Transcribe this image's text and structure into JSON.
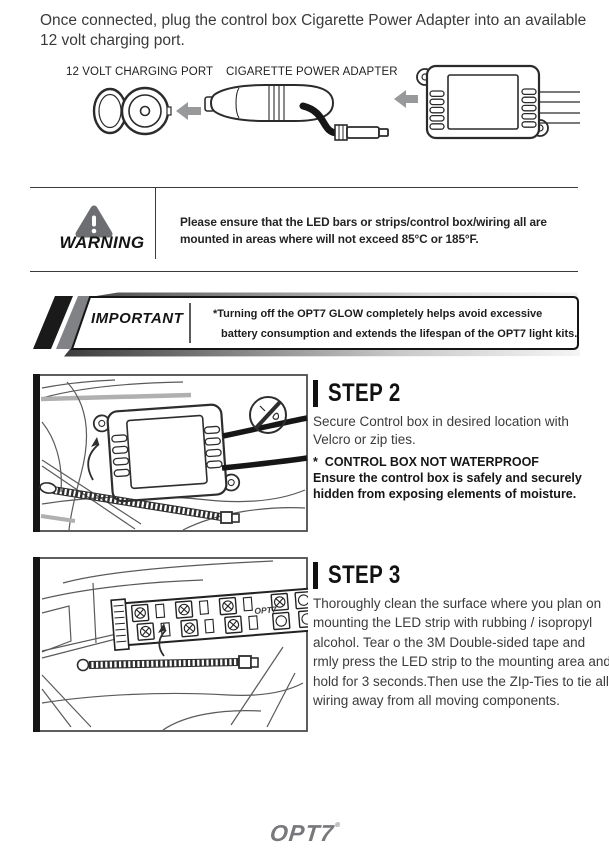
{
  "intro": {
    "text": "Once connected, plug the control box Cigarette Power Adapter into an available 12 volt charging port."
  },
  "connection_diagram": {
    "port_label": "12 VOLT CHARGING PORT",
    "adapter_label": "CIGARETTE POWER ADAPTER"
  },
  "warning": {
    "label": "WARNING",
    "text": "Please ensure that the LED bars or strips/control box/wiring all are mounted in areas where will not exceed 85°C or 185°F."
  },
  "important": {
    "label": "IMPORTANT",
    "line1": "*Turning off the OPT7 GLOW completely helps avoid excessive",
    "line2": "battery consumption and extends the  lifespan of the OPT7 light kits."
  },
  "step2": {
    "title": "STEP 2",
    "body": "Secure Control box in desired location with Velcro or zip ties.",
    "note_title": "*  CONTROL BOX NOT WATERPROOF",
    "note_body": "Ensure the control box is safely and securely hidden from exposing elements of moisture."
  },
  "step3": {
    "title": "STEP 3",
    "strip_brand": "OPT7",
    "body": "Thoroughly clean the surface where you plan on mounting the LED strip with rubbing / isopropyl alcohol. Tear o the 3M Double-sided tape and rmly press the LED strip to the mounting area and hold for 3 seconds.Then use the ZIp-Ties to tie all wiring away from all moving components."
  },
  "footer": {
    "logo": "OPT7",
    "mark": "®"
  },
  "colors": {
    "text_dark": "#2e2e2e",
    "arrow_gray": "#97999b",
    "warning_gray": "#6d6e71",
    "logo_gray": "#77787b"
  }
}
